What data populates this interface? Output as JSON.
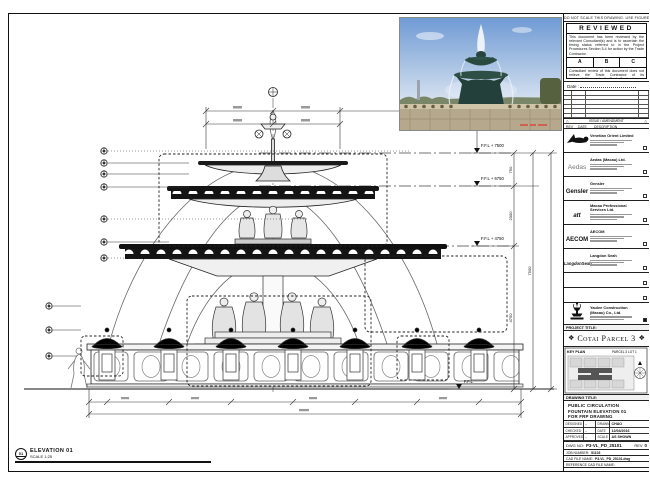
{
  "sheet_note": "DO NOT SCALE THIS DRAWING. USE FIGURED DIMENSIONS ONLY.",
  "stamp": {
    "title": "REVIEWED",
    "body1": "This document has been reviewed by the relevant Consultant(s) and is to ascertain the timing status referred to in the Project Procedures Section 5.4 for action by the Trade Contractor.",
    "options": [
      "A",
      "B",
      "C"
    ],
    "body2": "Consultant review of this document does not relieve the Trade Contractor of its responsibilities under the Trade Contract.",
    "date_label": "Date :"
  },
  "rev_footer": {
    "issue": "ISSUE / AMENDMENT",
    "cols": [
      "REV",
      "DATE",
      "DESCRIPTION"
    ]
  },
  "companies": [
    {
      "logo_text": "",
      "name": "Venetian Orient Limited"
    },
    {
      "logo_text": "Aedas",
      "name": "Aedas (Macau) Ltd."
    },
    {
      "logo_text": "Gensler",
      "name": "Gensler"
    },
    {
      "logo_text": "att",
      "name": "Macau Professional Services Ltd."
    },
    {
      "logo_text": "AECOM",
      "name": "AECOM"
    },
    {
      "logo_text": "LangdonSeah",
      "name": "Langdon Seah"
    }
  ],
  "contractor": {
    "name": "Yaulee Construction (Macau) Co., Ltd."
  },
  "project": {
    "label": "PROJECT TITLE:",
    "name": "Cotai Parcel 3"
  },
  "key_plan": {
    "label": "KEY PLAN",
    "parcel": "PARCEL 3 LOT 1"
  },
  "drawing": {
    "title_label": "DRAWING TITLE:",
    "title_line1": "PUBLIC CIRCULATION",
    "title_line2": "FOUNTAIN ELEVATION 01",
    "title_line3": "FOR FRP DRAWING",
    "designed_label": "DESIGNED",
    "designed": "-",
    "drawn_label": "DRAWN",
    "drawn": "CHAO",
    "checked_label": "CHECKED",
    "checked": "-",
    "date_label": "DATE",
    "date": "12/04/2016",
    "approved_label": "APPROVED",
    "approved": "-",
    "scale_label": "SCALE",
    "scale": "AS SHOWN",
    "dwg_no_label": "DWG NO:",
    "dwg_no": "P3-VL_PD_25101",
    "rev_label": "REV",
    "rev": "0",
    "job_label": "JOB NUMBER:",
    "job": "51103",
    "cad_label": "CAD FILE NAME:",
    "cad": "P3-VL_PD_25101.dwg",
    "ref_label": "REFERENCE CAD FILE NAME:"
  },
  "elevation_label": {
    "bubble_top": "01",
    "title": "ELEVATION 01",
    "scale": "SCALE 1:25"
  },
  "drawing_labels": {
    "ffl_7500": "F.F.L + 7500",
    "ffl_6750": "F.F.L + 6750",
    "ffl_4750": "F.F.L + 4750",
    "ffl_ground": "F.F.L"
  },
  "dims": {
    "seg_a": "750",
    "seg_b": "2000",
    "seg_c": "4750",
    "total": "7500"
  }
}
